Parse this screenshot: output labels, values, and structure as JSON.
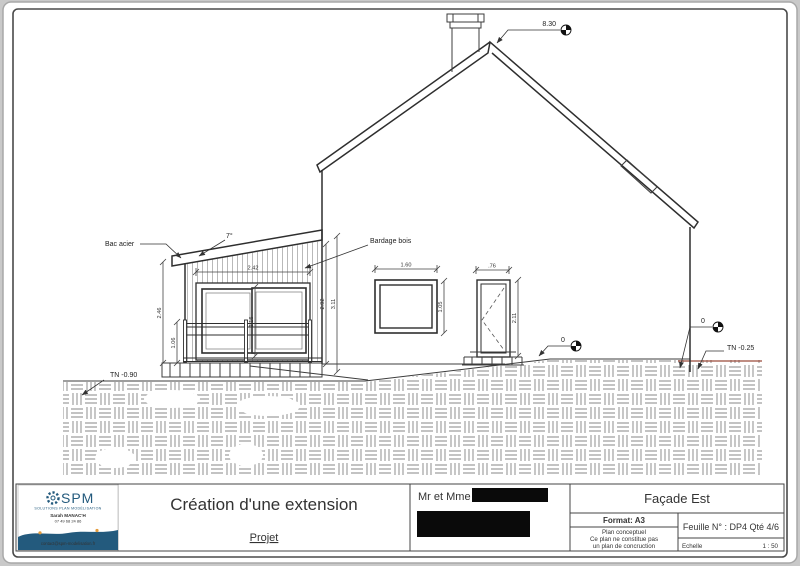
{
  "titleblock": {
    "project_title": "Création d'une extension",
    "project_subtitle": "Projet",
    "client_label": "Mr et Mme",
    "view_title": "Façade Est",
    "format_label": "Format: A3",
    "disclaimer_1": "Plan conceptuel",
    "disclaimer_2": "Ce plan ne constitue pas",
    "disclaimer_3": "un plan de concruction",
    "sheet_label": "Feuille N° : DP4 Qté 4/6",
    "scale_label": "Echelle",
    "scale_value": "1 : 50"
  },
  "logo": {
    "brand": "SPM",
    "tagline": "SOLUTIONS PLAN MODÉLISATION",
    "contact_name": "Sarah MANAC'H",
    "phone": "07 49 68 24 86",
    "email": "contact@spm-modelisation.fr"
  },
  "annotations": {
    "ridge_level": "8.30",
    "roof_slope": "7°",
    "bac_acier": "Bac acier",
    "bardage_bois": "Bardage bois",
    "tn_left": "TN -0.90",
    "tn_right": "TN -0.25",
    "level_zero_door": "0",
    "level_zero_corner": "0"
  },
  "dimensions": {
    "ext_bay_width": "2.42",
    "ext_height_left": "2.46",
    "railing_height": "1.06",
    "bay_height": "2.16",
    "ext_wall_height": "2.92",
    "ext_total_height": "3.11",
    "window_width": "1.60",
    "window_height": "1.05",
    "door_width": ".76",
    "door_height": "2.11"
  },
  "colors": {
    "line": "#3c3c3c",
    "terrain_marker": "#9b4a3a",
    "brand_navy": "#235a7d",
    "brand_orange": "#e39b3c"
  }
}
